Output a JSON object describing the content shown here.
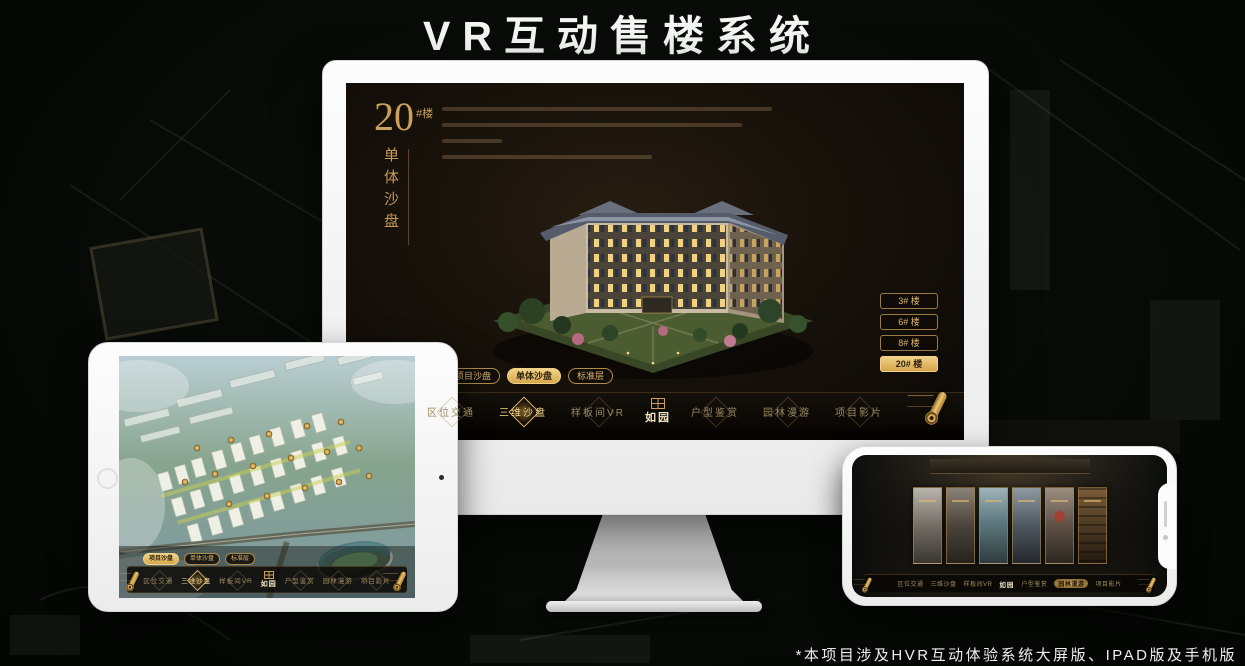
{
  "header": {
    "title": "VR互动售楼系统"
  },
  "footer": {
    "note": "*本项目涉及HVR互动体验系统大屏版、IPAD版及手机版"
  },
  "colors": {
    "accent_gold": "#caa05a",
    "active_gold": "#f2d287",
    "screen_bg": "#17110a",
    "device_white": "#fbfbfb"
  },
  "app": {
    "logo_text": "如园",
    "nav_items": [
      "区位交通",
      "三维沙盘",
      "样板间VR",
      "户型鉴赏",
      "园林漫游",
      "项目影片"
    ],
    "view_tabs": [
      "项目沙盘",
      "单体沙盘",
      "标准层"
    ]
  },
  "monitor": {
    "block_number": "20",
    "block_suffix": "#楼",
    "block_subtitle": "单体沙盘",
    "floor_buttons": [
      "3# 楼",
      "6# 楼",
      "8# 楼",
      "20# 楼"
    ],
    "active_floor": "20# 楼",
    "active_tab": "单体沙盘",
    "active_nav": "三维沙盘"
  },
  "tablet": {
    "active_tab": "项目沙盘",
    "active_nav": "三维沙盘"
  },
  "phone": {
    "active_nav": "园林漫游"
  }
}
